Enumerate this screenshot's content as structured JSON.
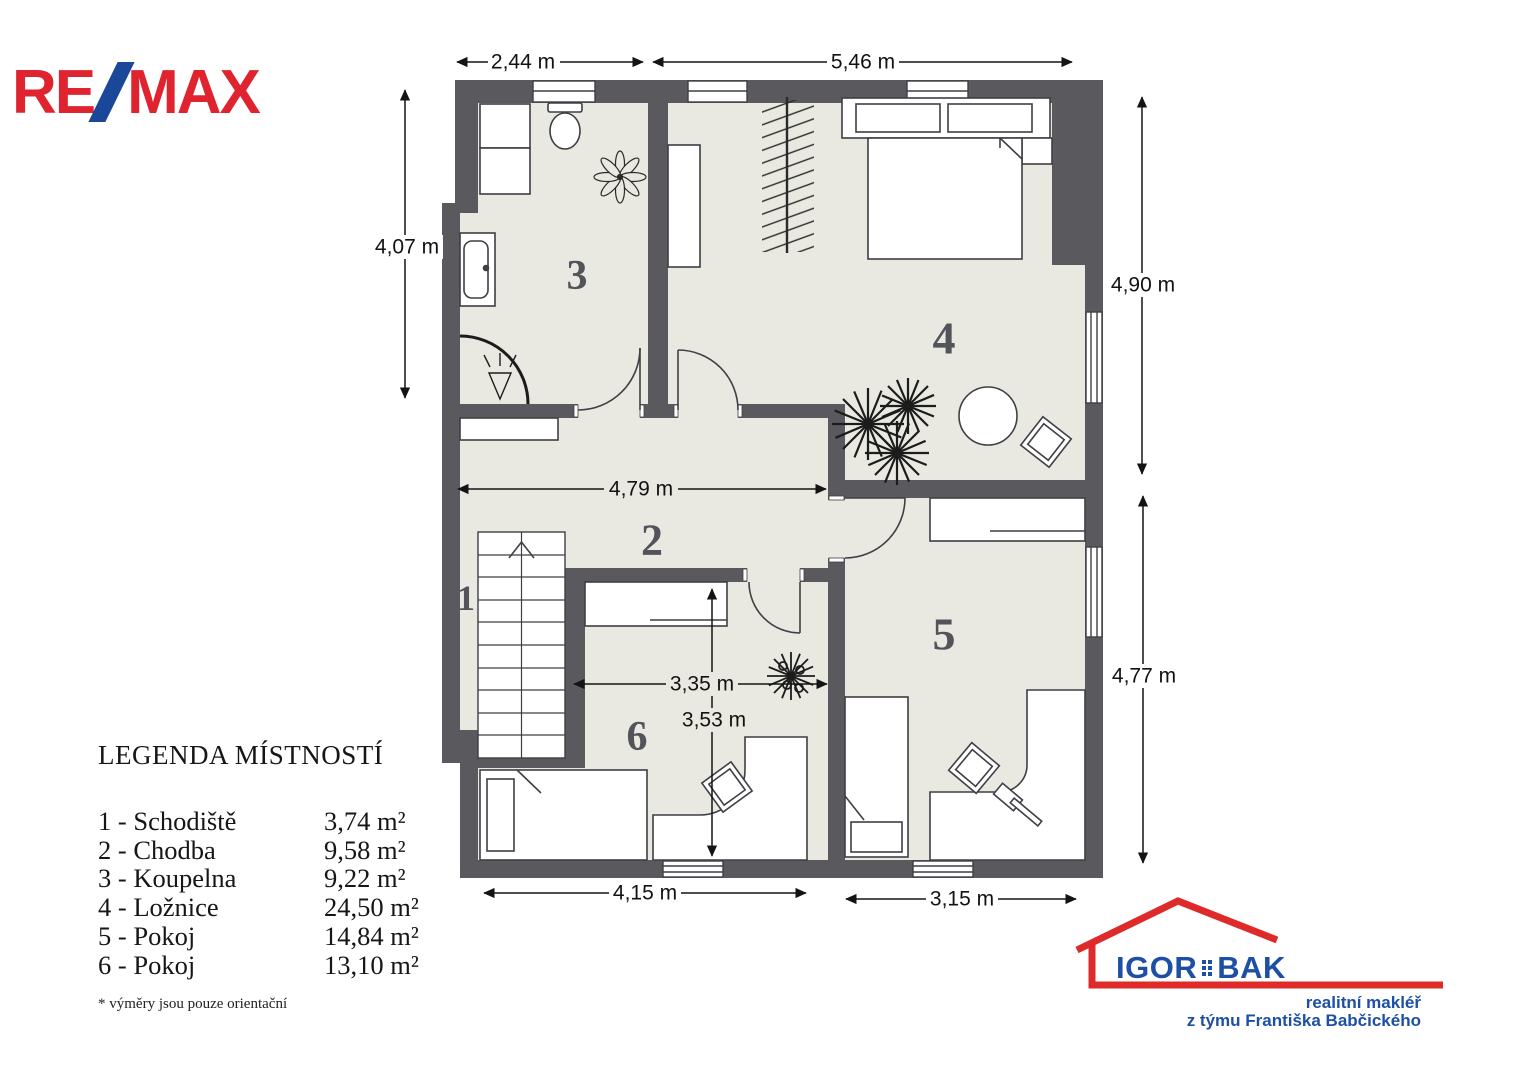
{
  "remax": {
    "re": "RE",
    "max": "MAX"
  },
  "legend": {
    "title": "LEGENDA MÍSTNOSTÍ",
    "items": [
      {
        "label": "1 - Schodiště",
        "area": "3,74 m²"
      },
      {
        "label": "2 - Chodba",
        "area": "9,58  m²"
      },
      {
        "label": "3 - Koupelna",
        "area": "9,22 m²"
      },
      {
        "label": "4 - Ložnice",
        "area": "24,50 m²"
      },
      {
        "label": "5 - Pokoj",
        "area": "14,84 m²"
      },
      {
        "label": "6 - Pokoj",
        "area": "13,10 m²"
      }
    ],
    "footnote": "* výměry jsou pouze orientační"
  },
  "rooms": {
    "r1": "1",
    "r2": "2",
    "r3": "3",
    "r4": "4",
    "r5": "5",
    "r6": "6"
  },
  "dimensions": {
    "top_left": "2,44 m",
    "top_right": "5,46 m",
    "left": "4,07 m",
    "right_top": "4,90 m",
    "right_bottom": "4,77 m",
    "hall_width": "4,79 m",
    "room6_width": "3,35 m",
    "room6_height": "3,53 m",
    "bottom_left": "4,15 m",
    "bottom_right": "3,15 m"
  },
  "agent": {
    "igor": "IGOR",
    "bak": "BAK",
    "line1": "realitní makléř",
    "line2": "z týmu Františka Babčického"
  },
  "colors": {
    "wall": "#59595e",
    "floor": "#e9e9e2",
    "outline": "#3f3f44",
    "dimension_text": "#121212",
    "room_number": "#53535a",
    "remax_red": "#e0242f",
    "remax_blue": "#1b4798",
    "agent_blue": "#1d4fa5",
    "agent_red": "#df2a2a"
  }
}
